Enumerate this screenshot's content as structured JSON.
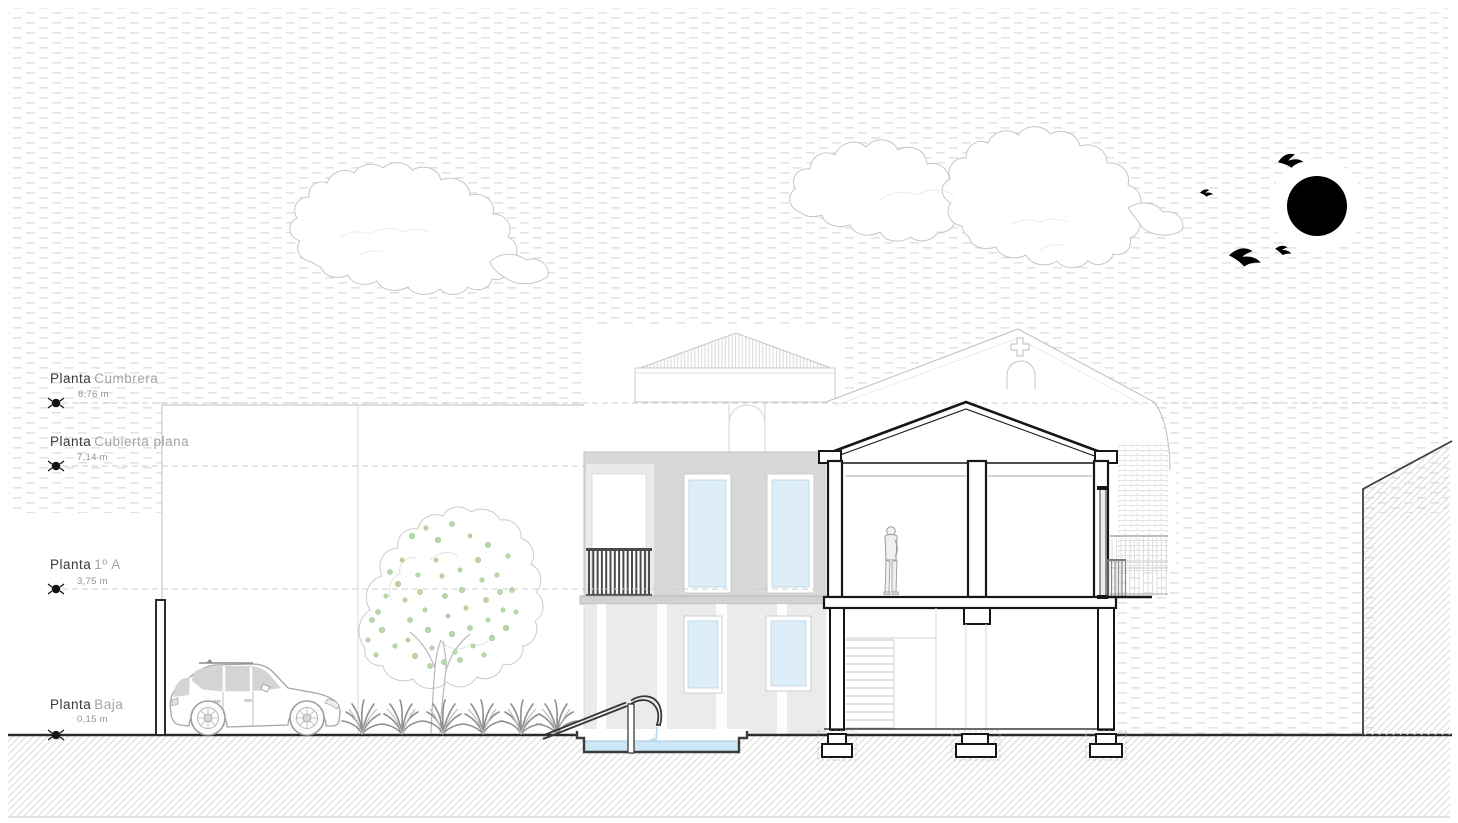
{
  "drawing": {
    "type": "architectural-section-elevation",
    "levels": [
      {
        "name": "Planta",
        "qualifier": "Cumbrera",
        "elevation": "8,76 m"
      },
      {
        "name": "Planta",
        "qualifier": "Cubierta plana",
        "elevation": "7,14 m"
      },
      {
        "name": "Planta",
        "qualifier": "1º A",
        "elevation": "3,75 m"
      },
      {
        "name": "Planta",
        "qualifier": "Baja",
        "elevation": "0,15 m"
      }
    ],
    "icons": {
      "sun": "filled-black-circle",
      "bird": "bird-silhouette",
      "level_marker": "survey-benchmark",
      "cross": "church-cross"
    },
    "colors": {
      "sun": "#000000",
      "water": "#cde7f7",
      "foliage": "#b9d7aa",
      "facade_upper": "#d8d8d8",
      "facade_lower": "#ebebeb",
      "section_line": "#161616",
      "sky_pattern": "#e3e3e3",
      "ground_line": "#2b2b2b"
    }
  }
}
